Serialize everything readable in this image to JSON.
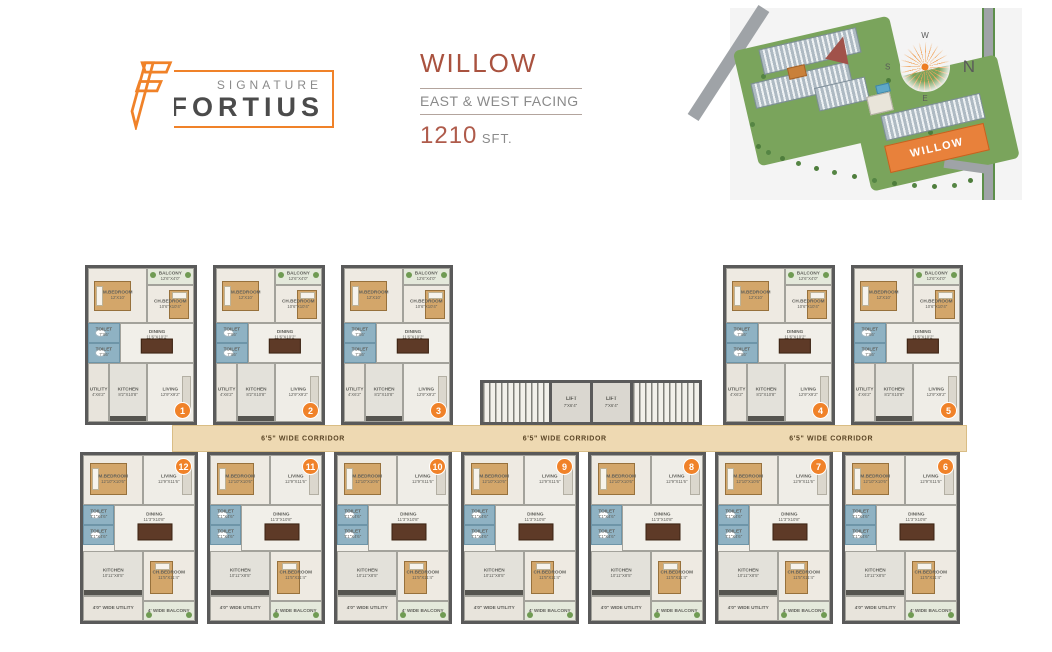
{
  "colors": {
    "accent_orange": "#F08229",
    "title_red": "#A9523F",
    "corridor_tan": "#EED9B2",
    "toilet_blue": "#8FB2C3",
    "willow_building_orange": "#E8813B"
  },
  "header": {
    "logo": {
      "signature": "SIGNATURE",
      "fortius": "FORTIUS"
    },
    "title": "WILLOW",
    "facing": "EAST & WEST FACING",
    "area_value": "1210",
    "area_unit": "SFT."
  },
  "sitemap": {
    "willow_label": "WILLOW",
    "compass": {
      "n": "N",
      "s": "S",
      "e": "E",
      "w": "W"
    }
  },
  "floorplan": {
    "corridor_label": "6'5\" WIDE CORRIDOR",
    "lift_label": "LIFT",
    "lift_dim": "7'X6'4\"",
    "top_left_units": [
      "1",
      "2",
      "3"
    ],
    "top_right_units": [
      "4",
      "5"
    ],
    "bottom_units": [
      "12",
      "11",
      "10",
      "9",
      "8",
      "7",
      "6"
    ],
    "top_unit_rooms": {
      "balcony": {
        "name": "BALCONY",
        "dim": "12'6\"X4'0\""
      },
      "mbedroom": {
        "name": "M.BEDROOM",
        "dim": "12'X10'"
      },
      "chbedroom": {
        "name": "CH.BEDROOM",
        "dim": "10'6\"X10'4\""
      },
      "toilet1": {
        "name": "TOILET",
        "dim": "7'X6'"
      },
      "toilet2": {
        "name": "TOILET",
        "dim": "7'X6'"
      },
      "dining": {
        "name": "DINING",
        "dim": "11'6\"X10'2\""
      },
      "utility": {
        "name": "UTILITY",
        "dim": "4'X6'2\""
      },
      "kitchen": {
        "name": "KITCHEN",
        "dim": "8'2\"X10'8\""
      },
      "living": {
        "name": "LIVING",
        "dim": "12'9\"X9'2\""
      }
    },
    "bottom_unit_rooms": {
      "mbedroom": {
        "name": "M.BEDROOM",
        "dim": "12'10\"X10'6\""
      },
      "living": {
        "name": "LIVING",
        "dim": "12'9\"X11'6\""
      },
      "toilet1": {
        "name": "TOILET",
        "dim": "7'1\"X4'6\""
      },
      "toilet2": {
        "name": "TOILET",
        "dim": "7'1\"X4'6\""
      },
      "dining": {
        "name": "DINING",
        "dim": "11'3\"X10'8\""
      },
      "kitchen": {
        "name": "KITCHEN",
        "dim": "10'11\"X8'5\""
      },
      "chbedroom": {
        "name": "CH.BEDROOM",
        "dim": "11'5\"X11'4\""
      },
      "utility": {
        "name": "4'0\" WIDE UTILITY"
      },
      "balcony": {
        "name": "4' WIDE BALCONY"
      }
    }
  }
}
